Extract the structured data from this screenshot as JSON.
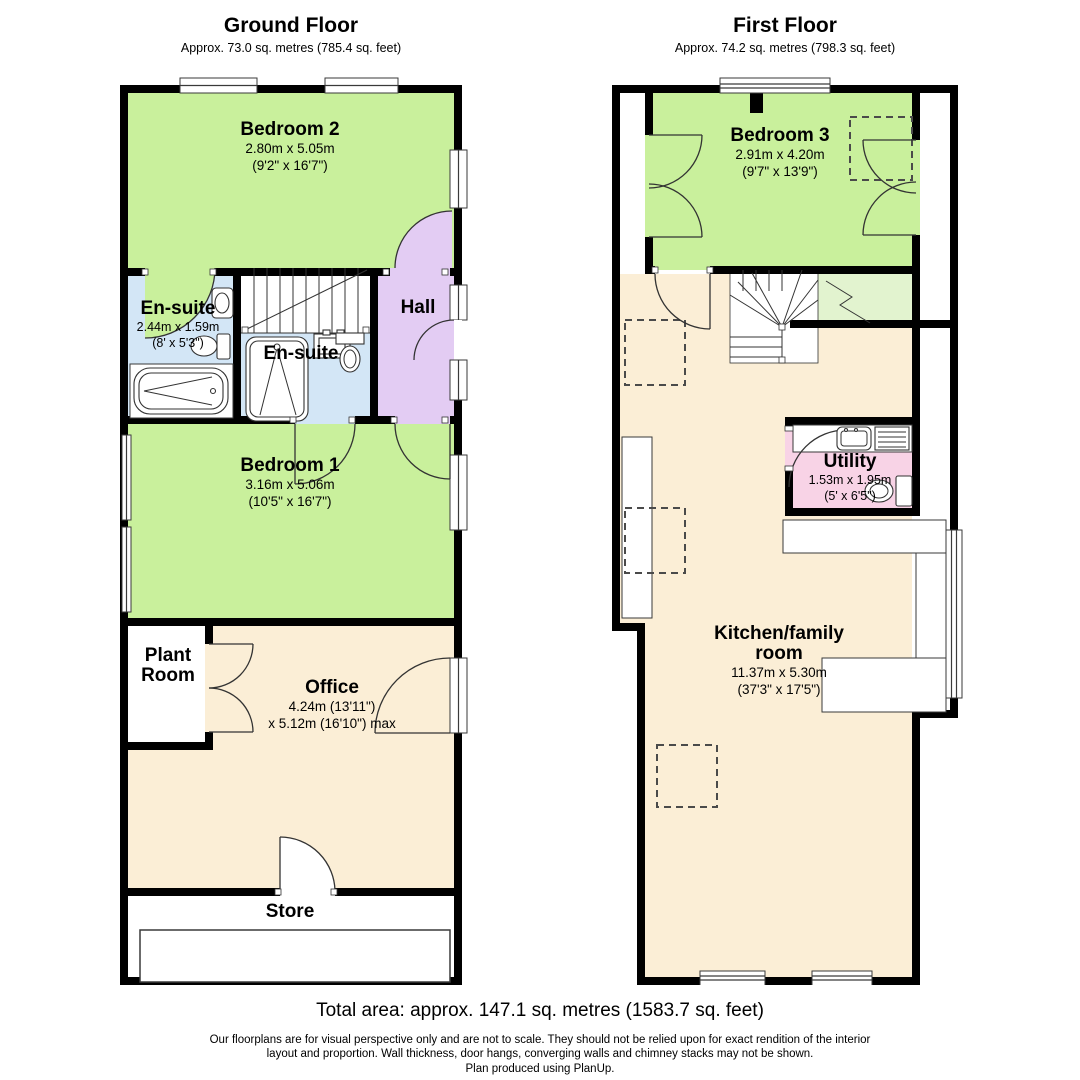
{
  "colors": {
    "wall": "#000000",
    "green": "#c9f09c",
    "pale_green": "#e2f3cf",
    "blue": "#d3e6f6",
    "purple": "#e3ccf3",
    "tan": "#fbeed6",
    "pink": "#f8d3e6",
    "line": "#333333",
    "dash": "#4a4a4a"
  },
  "floors": {
    "ground": {
      "title": "Ground Floor",
      "subtitle": "Approx. 73.0 sq. metres (785.4 sq. feet)",
      "rooms": {
        "bedroom2": {
          "name": "Bedroom 2",
          "dims1": "2.80m x 5.05m",
          "dims2": "(9'2\" x 16'7\")"
        },
        "ensuite1": {
          "name": "En-suite",
          "dims1": "2.44m x 1.59m",
          "dims2": "(8' x 5'3\")"
        },
        "ensuite2": {
          "name": "En-suite"
        },
        "hall": {
          "name": "Hall"
        },
        "bedroom1": {
          "name": "Bedroom 1",
          "dims1": "3.16m x 5.06m",
          "dims2": "(10'5\" x 16'7\")"
        },
        "plant_room": {
          "name": "Plant Room"
        },
        "office": {
          "name": "Office",
          "dims1": "4.24m (13'11\")",
          "dims2": "x 5.12m (16'10\") max"
        },
        "store": {
          "name": "Store"
        }
      }
    },
    "first": {
      "title": "First Floor",
      "subtitle": "Approx. 74.2 sq. metres (798.3 sq. feet)",
      "rooms": {
        "bedroom3": {
          "name": "Bedroom 3",
          "dims1": "2.91m x 4.20m",
          "dims2": "(9'7\" x 13'9\")"
        },
        "utility": {
          "name": "Utility",
          "dims1": "1.53m x 1.95m",
          "dims2": "(5' x 6'5\")"
        },
        "kitchen": {
          "name": "Kitchen/family room",
          "dims1": "11.37m x 5.30m",
          "dims2": "(37'3\" x 17'5\")"
        }
      }
    }
  },
  "footer": {
    "total_area": "Total area: approx. 147.1 sq. metres (1583.7 sq. feet)",
    "disclaimer_lines": [
      "Our floorplans are for visual perspective only and are not to scale.  They should not be relied upon for exact rendition of the interior",
      "layout and proportion.  Wall thickness, door hangs, converging walls and chimney stacks may not be shown.",
      "Plan produced using PlanUp."
    ]
  }
}
